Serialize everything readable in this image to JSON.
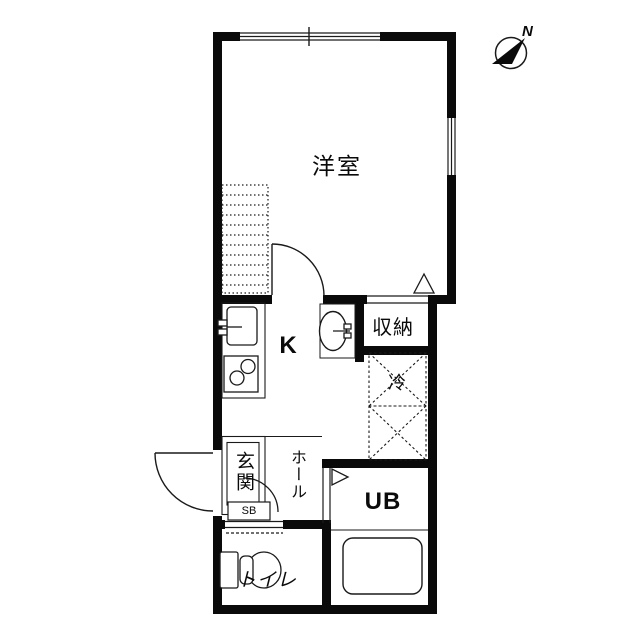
{
  "compass": {
    "north_label": "N"
  },
  "labels": {
    "western_room": "洋室",
    "kitchen": "K",
    "storage": "収納",
    "refrigerator": "冷",
    "entrance": "玄関",
    "hall": "ホール",
    "shoe_box": "SB",
    "unit_bath": "UB",
    "toilet": "トイレ"
  },
  "colors": {
    "wall": "#0a0a0a",
    "background": "#ffffff",
    "thin_line": "#1a1a1a"
  }
}
